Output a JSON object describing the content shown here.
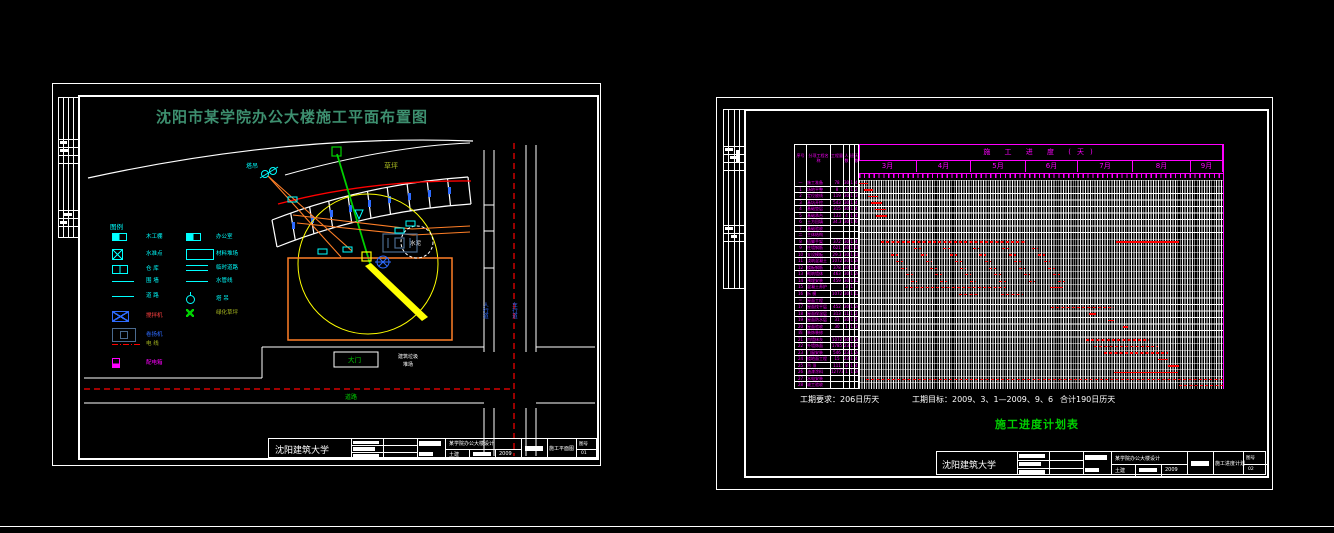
{
  "colors": {
    "background": "#000000",
    "frame": "#ffffff",
    "magenta": "#ff00ff",
    "cyan": "#00ffff",
    "red": "#ff0000",
    "yellow": "#ffff00",
    "orange": "#ff7f27",
    "bright_green": "#00d000",
    "title_green": "#3d8f6f",
    "olive": "#a8b820",
    "blue": "#2e6bff",
    "slate_blue": "#4a6a8f"
  },
  "left_sheet": {
    "title": "沈阳市某学院办公大楼施工平面布置图",
    "legend": {
      "title": "图例",
      "col1": [
        {
          "label": "木工棚",
          "symbol": "shed-symbol",
          "cls": "s-halfrect"
        },
        {
          "label": "水准点",
          "symbol": "benchmark-symbol",
          "cls": "s-xbox"
        },
        {
          "label": "仓 库",
          "symbol": "warehouse-symbol",
          "cls": "s-2box"
        },
        {
          "label": "围 墙",
          "symbol": "fence-symbol",
          "cls": "s-line"
        },
        {
          "label": "道 路",
          "symbol": "road-symbol",
          "cls": "s-line"
        },
        {
          "label": "搅拌机",
          "symbol": "mixer-symbol",
          "cls": "s-xbox s-blue s-wide",
          "color": "red"
        },
        {
          "label": "卷扬机",
          "symbol": "hoist-symbol",
          "cls": "s-hoist",
          "color": "blue"
        },
        {
          "label": "电 线",
          "symbol": "powerline-symbol",
          "cls": "s-dashdot",
          "color": "olive"
        },
        {
          "label": "配电箱",
          "symbol": "distribution-box-symbol",
          "cls": "s-magbox",
          "color": "magenta"
        }
      ],
      "col2": [
        {
          "label": "办公室",
          "symbol": "office-symbol",
          "cls": "s-halfrect"
        },
        {
          "label": "材料堆场",
          "symbol": "stockyard-symbol",
          "cls": "s-bigrect"
        },
        {
          "label": "临时道路",
          "symbol": "temp-road-symbol",
          "cls": "s-2line"
        },
        {
          "label": "水管线",
          "symbol": "waterline-symbol",
          "cls": "s-line"
        },
        {
          "label": "塔 吊",
          "symbol": "tower-crane-symbol",
          "cls": "s-crane"
        },
        {
          "label": "绿化草坪",
          "symbol": "lawn-symbol",
          "cls": "s-greenx",
          "color": "olive"
        }
      ]
    },
    "plan": {
      "crane_label": "塔吊",
      "lawn_label": "草坪",
      "mixer_label": "水泥",
      "gate_label": "大门",
      "note_line1": "建筑垃圾",
      "note_line2": "堆场",
      "road_name": "道路",
      "sidewalk_label": "人行道",
      "roadway_label": "车行道"
    },
    "title_block": {
      "school": "沈阳建筑大学",
      "project": "某学院办公大楼设计",
      "discipline": "土建",
      "year": "2009",
      "drawing": "施工平面图",
      "sheet_label": "图号",
      "sheet_no": "01"
    }
  },
  "right_sheet": {
    "chart_data": {
      "type": "gantt",
      "title": "施 工 进 度 (天)",
      "months": [
        "3月",
        "4月",
        "5月",
        "6月",
        "7月",
        "8月",
        "9月"
      ],
      "month_widths": [
        58,
        54,
        55,
        52,
        55,
        58,
        32
      ],
      "columns": [
        "序号",
        "分项工程名称",
        "工程量",
        "人数",
        "班",
        "天数"
      ],
      "rows": [
        [
          "一",
          "施工准备",
          "78",
          "30",
          "1",
          "4"
        ],
        [
          "1",
          "场地平整",
          "8",
          "4",
          "1",
          "2"
        ],
        [
          "2",
          "定位放线",
          "119",
          "30",
          "1",
          "3"
        ],
        [
          "3",
          "基坑开挖",
          "543",
          "30",
          "1",
          "4"
        ],
        [
          "4",
          "基础垫层",
          "315",
          "30",
          "1",
          "4"
        ],
        [
          "5",
          "基础承台",
          "133",
          "4",
          "1",
          "4"
        ],
        [
          "6",
          "土方回填",
          "34.3",
          "30",
          "1",
          "6"
        ],
        [
          "7",
          "基础验收",
          "",
          "",
          "",
          ""
        ],
        [
          "二",
          "主体结构",
          "",
          "",
          "",
          ""
        ],
        [
          "8",
          "搭脚手架",
          "372",
          "30",
          "1",
          "4"
        ],
        [
          "9",
          "柱墙钢筋",
          "621",
          "30",
          "1",
          "10"
        ],
        [
          "10",
          "支设模板",
          "29.3",
          "30",
          "1",
          "10"
        ],
        [
          "11",
          "浇筑混凝土",
          "1072",
          "30",
          "1",
          "24"
        ],
        [
          "12",
          "楼板钢筋",
          "378",
          "30",
          "1",
          "10"
        ],
        [
          "13",
          "砌筑墙体",
          "463",
          "30",
          "1",
          "24"
        ],
        [
          "14",
          "预埋安装",
          "459",
          "30",
          "1",
          "12"
        ],
        [
          "15",
          "混凝土养护",
          "",
          "3",
          "1",
          ""
        ],
        [
          "16",
          "拆 模",
          "1072",
          "30",
          "1",
          "12"
        ],
        [
          "三",
          "屋面工程",
          "",
          "",
          "",
          ""
        ],
        [
          "17",
          "屋面找平层",
          "452",
          "30",
          "1",
          "24"
        ],
        [
          "18",
          "屋面保温层",
          "313",
          "11",
          "1",
          "2"
        ],
        [
          "19",
          "屋面防水层",
          "31",
          "30",
          "1",
          "5"
        ],
        [
          "20",
          "屋面验收",
          "30",
          "1",
          "1",
          "3"
        ],
        [
          "四",
          "装饰装修",
          "",
          "",
          "",
          ""
        ],
        [
          "21",
          "内墙抹灰",
          "1072",
          "30",
          "1",
          "24"
        ],
        [
          "22",
          "外墙饰面",
          "1785",
          "23",
          "1",
          "24"
        ],
        [
          "23",
          "门窗安装",
          "546",
          "23",
          "1",
          "24"
        ],
        [
          "24",
          "楼地面工程",
          "15",
          "23",
          "1",
          "4"
        ],
        [
          "25",
          "吊 顶",
          "111",
          "8",
          "1",
          "4"
        ],
        [
          "26",
          "油漆涂料",
          "12773",
          "1",
          "1",
          "24"
        ],
        [
          "27",
          "水电安装",
          "",
          "",
          "",
          ""
        ],
        [
          "28",
          "竣工验收",
          "",
          "",
          "",
          ""
        ]
      ],
      "bars": [
        {
          "r": 0,
          "s": 0.0,
          "e": 0.025
        },
        {
          "r": 1,
          "s": 0.014,
          "e": 0.039
        },
        {
          "r": 2,
          "s": 0.025,
          "e": 0.052
        },
        {
          "r": 3,
          "s": 0.033,
          "e": 0.063
        },
        {
          "r": 4,
          "s": 0.044,
          "e": 0.074
        },
        {
          "r": 5,
          "s": 0.047,
          "e": 0.077
        },
        {
          "r": 9,
          "s": 0.06,
          "e": 0.46,
          "d": 1
        },
        {
          "r": 9,
          "s": 0.706,
          "e": 0.879
        },
        {
          "r": 16,
          "s": 0.125,
          "e": 0.405,
          "d": 1
        },
        {
          "r": 16,
          "s": 0.525,
          "e": 0.56
        },
        {
          "r": 17,
          "s": 0.275,
          "e": 0.33,
          "d": 1
        },
        {
          "r": 17,
          "s": 0.39,
          "e": 0.45,
          "d": 1
        },
        {
          "r": 19,
          "s": 0.527,
          "e": 0.7,
          "d": 1
        },
        {
          "r": 20,
          "s": 0.632,
          "e": 0.651
        },
        {
          "r": 21,
          "s": 0.684,
          "e": 0.7
        },
        {
          "r": 22,
          "s": 0.725,
          "e": 0.739
        },
        {
          "r": 24,
          "s": 0.623,
          "e": 0.797,
          "d": 1
        },
        {
          "r": 25,
          "s": 0.645,
          "e": 0.822,
          "d": 1
        },
        {
          "r": 26,
          "s": 0.673,
          "e": 0.849,
          "d": 1
        },
        {
          "r": 27,
          "s": 0.821,
          "e": 0.849
        },
        {
          "r": 28,
          "s": 0.849,
          "e": 0.879
        },
        {
          "r": 29,
          "s": 0.7,
          "e": 0.876
        },
        {
          "r": 30,
          "s": 0.02,
          "e": 1.0,
          "d": 1
        },
        {
          "r": 31,
          "s": 0.879,
          "e": 1.0,
          "d": 1
        }
      ],
      "cycles": [
        {
          "r": 10,
          "s": 0.151,
          "n": 5,
          "st": 0.081,
          "w": 0.018
        },
        {
          "r": 11,
          "s": 0.088,
          "n": 6,
          "st": 0.081,
          "w": 0.018
        },
        {
          "r": 12,
          "s": 0.102,
          "n": 6,
          "st": 0.081,
          "w": 0.018
        },
        {
          "r": 13,
          "s": 0.115,
          "n": 6,
          "st": 0.081,
          "w": 0.018
        },
        {
          "r": 14,
          "s": 0.129,
          "n": 6,
          "st": 0.081,
          "w": 0.018
        },
        {
          "r": 15,
          "s": 0.142,
          "n": 6,
          "st": 0.081,
          "w": 0.018
        }
      ]
    },
    "notes": {
      "duration": "工期要求：206日历天",
      "target": "工期目标：2009、3、1—2009、9、6",
      "total": "合计190日历天"
    },
    "title": "施工进度计划表",
    "title_block": {
      "school": "沈阳建筑大学",
      "project": "某学院办公大楼设计",
      "discipline": "土建",
      "year": "2009",
      "drawing": "施工进度计划",
      "sheet_label": "图号",
      "sheet_no": "02"
    }
  }
}
